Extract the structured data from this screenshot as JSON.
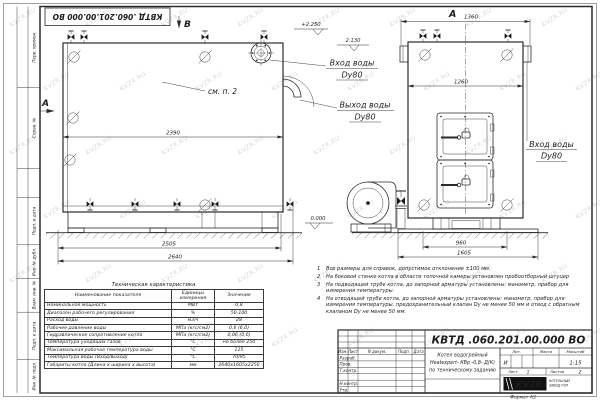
{
  "sheet": {
    "stamp_top": "КВТД .060.201.00.000  ВО",
    "format_label": "Формат  А3",
    "watermark": "KVZR.RU",
    "margin_labels": [
      "Перв. примен.",
      "Справ. №",
      "Подп. и дата",
      "Инв. № дубл.",
      "Взам. инв. №",
      "Подп. и дата",
      "Инв. № подл."
    ]
  },
  "views": {
    "side": {
      "view_marker_b": "В",
      "view_marker_a": "А",
      "see_note": "см. п. 2",
      "dim_top": "2390",
      "dim_mid": "2505",
      "dim_total": "2640",
      "elev_top": "+2.250",
      "elev_nozzle": "2.130",
      "elev_ground": "0.000",
      "inlet_label": "Вход воды",
      "inlet_dn": "Dy80",
      "outlet_label": "Выход воды",
      "outlet_dn": "Dy80"
    },
    "front": {
      "view_title": "А",
      "dim_top": "1360",
      "dim_inner": "1260",
      "dim_base": "960",
      "dim_total": "1605",
      "inlet_label": "Вход воды",
      "inlet_dn": "Dy80"
    }
  },
  "tech_table": {
    "title": "Техническая характеристика",
    "headers": [
      "Наименование показателя",
      "Единицы измерения",
      "Значение"
    ],
    "rows": [
      {
        "name": "Номинальная мощность",
        "unit": "МВт",
        "value": "0,8"
      },
      {
        "name": "Диапазон рабочего регулирования",
        "unit": "%",
        "value": "50-100"
      },
      {
        "name": "Расход воды",
        "unit": "м3/ч",
        "value": "28"
      },
      {
        "name": "Рабочее давление воды",
        "unit": "МПа (кгс/см2)",
        "value": "0,6 (6,0)"
      },
      {
        "name": "Гидравлическое сопротивление котла",
        "unit": "МПа (кгс/см2)",
        "value": "0,06 (0,6)"
      },
      {
        "name": "Температура уходящих газов",
        "unit": "°С",
        "value": "не более 250"
      },
      {
        "name": "Максимальная рабочая температура воды",
        "unit": "°С",
        "value": "115"
      },
      {
        "name": "Температура воды (Вход/выход)",
        "unit": "°С",
        "value": "70/95"
      },
      {
        "name": "Габариты котла (Длина х ширина х высота)",
        "unit": "мм",
        "value": "2640х1605х2250"
      }
    ]
  },
  "notes": {
    "items": [
      {
        "num": "1",
        "text": "Все размеры для справок, допустимое отклонение ±100 мм."
      },
      {
        "num": "2",
        "text": "На боковой стенке котла в области топочной камеры установлен пробоотборный штуцер"
      },
      {
        "num": "3",
        "text": "На подводящей трубе котла, до запорной арматуры установлены: манометр, прибор для измерения температуры."
      },
      {
        "num": "4",
        "text": "На отводящей трубе котла, до запорной арматуры установлены: манометр, прибор для измерения температуры, предохранительный клапан Dy не менее 50 мм и отвод с обратным клапаном Dy не менее 50 мм."
      }
    ]
  },
  "title_block": {
    "doc_number": "КВТД .060.201.00.000  ВО",
    "title_line1": "Котел водогрейный",
    "title_line2": "Heatexpert- КВр -0,8- Д(К)",
    "title_line3": "по техническому заданию",
    "header_cols": [
      "Изм.",
      "Лист",
      "N докум.",
      "Подп.",
      "Дата"
    ],
    "row_labels": [
      "Разраб.",
      "Пров.",
      "Т.контр.",
      "",
      "Н.контр.",
      "Утв."
    ],
    "lit_header": "Лит.",
    "mass_header": "Масса",
    "scale_header": "Масштаб",
    "lit_value": "И",
    "scale_value": "1:15",
    "sheet_label": "Лист",
    "sheet_value": "1",
    "sheets_label": "Листов",
    "sheets_value": "2",
    "company_abbr": "KVZR",
    "company_line1": "КОТЕЛЬНЫЙ",
    "company_line2": "ЗАВОД РЭП"
  }
}
